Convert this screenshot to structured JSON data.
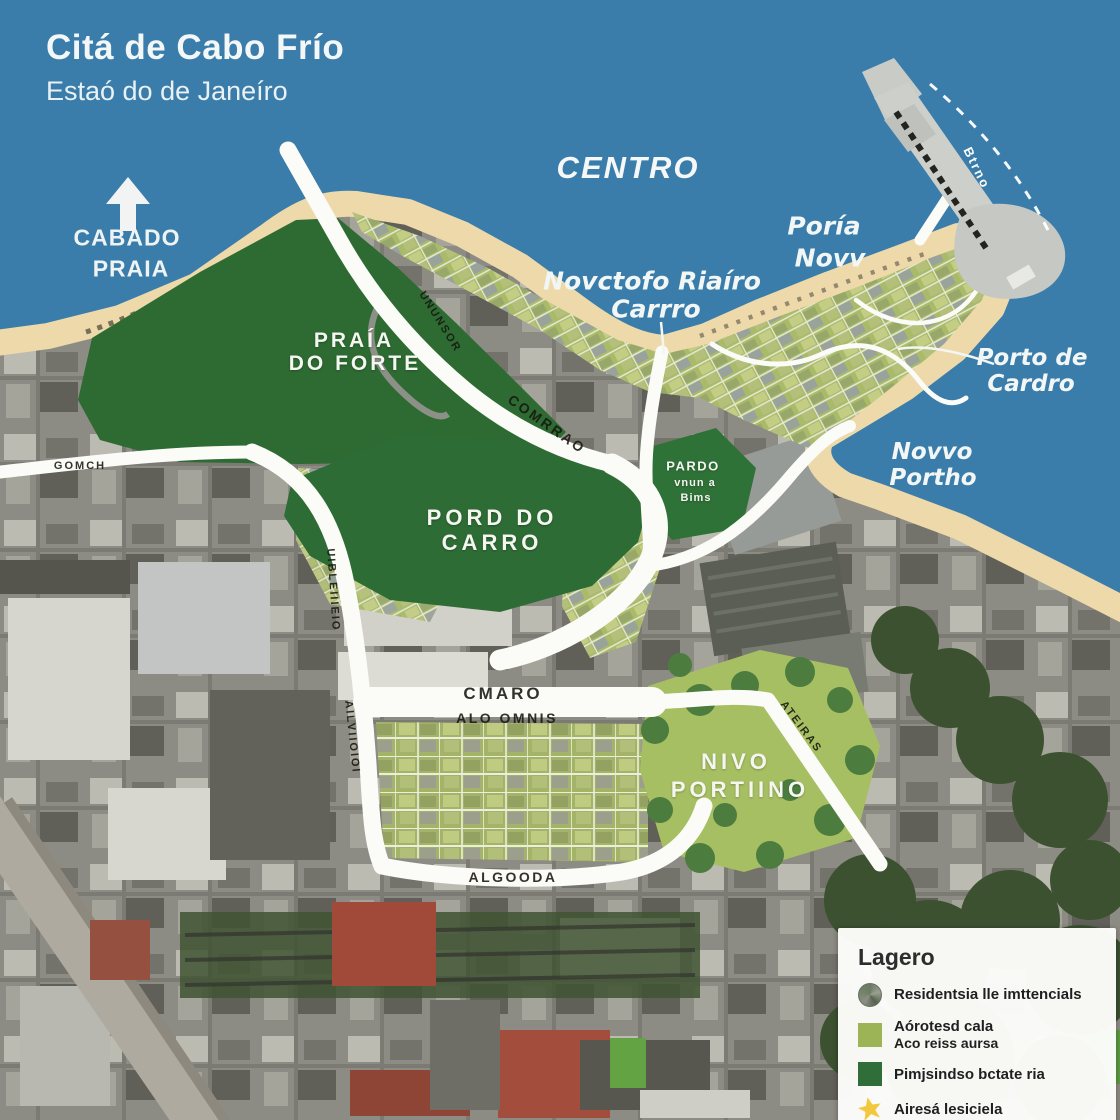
{
  "title": {
    "line1": "Citá de Cabo Frío",
    "line2": "Estaó do de Janeíro"
  },
  "compass": {
    "icon": "north-arrow",
    "line1": "CABADO",
    "line2": "PRAIA"
  },
  "water_labels": {
    "centro": "CENTRO",
    "poria": {
      "line1": "Poría",
      "line2": "Novv"
    },
    "novctofo": {
      "line1": "Novctofo Riaíro",
      "line2": "Carrro"
    },
    "porto_de_cardro": {
      "line1": "Porto de",
      "line2": "Cardro"
    },
    "novvo_portho": {
      "line1": "Novvo",
      "line2": "Portho"
    },
    "pier_name": "Btrno"
  },
  "area_labels": {
    "praia_do_forte": {
      "line1": "PRAÍA",
      "line2": "DO FORTE"
    },
    "pord_do_carro": {
      "line1": "PORD DO",
      "line2": "CARRO"
    },
    "pardo_park": {
      "line1": "PARDO",
      "line2": "vnun a",
      "line3": "Bims"
    },
    "nivo_portiino": {
      "line1": "NIVO",
      "line2": "PORTIINO"
    }
  },
  "road_labels": {
    "gomch": "GOMCH",
    "vertical_west_upper": "UIBLEIIIEIO",
    "vertical_west_lower": "AILVIIOIOI",
    "diagonal_beach": "UNUNSOR",
    "comrrao": "COMRRAO",
    "cmaro": "CMARO",
    "alo_omnis": "ALO OMNIS",
    "algooda": "ALGOODA",
    "ateiras": "ATEIRAS"
  },
  "legend": {
    "title": "Lagero",
    "items": [
      {
        "swatch": "satellite-circle",
        "label": "Residentsia lle imttencials"
      },
      {
        "swatch": "olive-square",
        "line1": "Aórotesd cala",
        "line2": "Aco reiss aursa"
      },
      {
        "swatch": "dark-green-square",
        "label": "Pimjsindso bctate ria"
      },
      {
        "swatch": "yellow-star",
        "label": "Airesá lesiciela"
      }
    ]
  },
  "colors": {
    "water": "#3a7dab",
    "sand": "#eed9ab",
    "park_dark_green": "#2d6b33",
    "park_light_green": "#a7bf63",
    "residential_olive": "#a9ba69",
    "road_white": "#fbfbf7",
    "pier_gray": "#cdcfca",
    "legend_olive": "#9cb456",
    "legend_dark_green": "#2f6e38",
    "legend_star_yellow": "#f3c83e",
    "label_white": "#f4f6f2",
    "road_text": "#17170f"
  }
}
